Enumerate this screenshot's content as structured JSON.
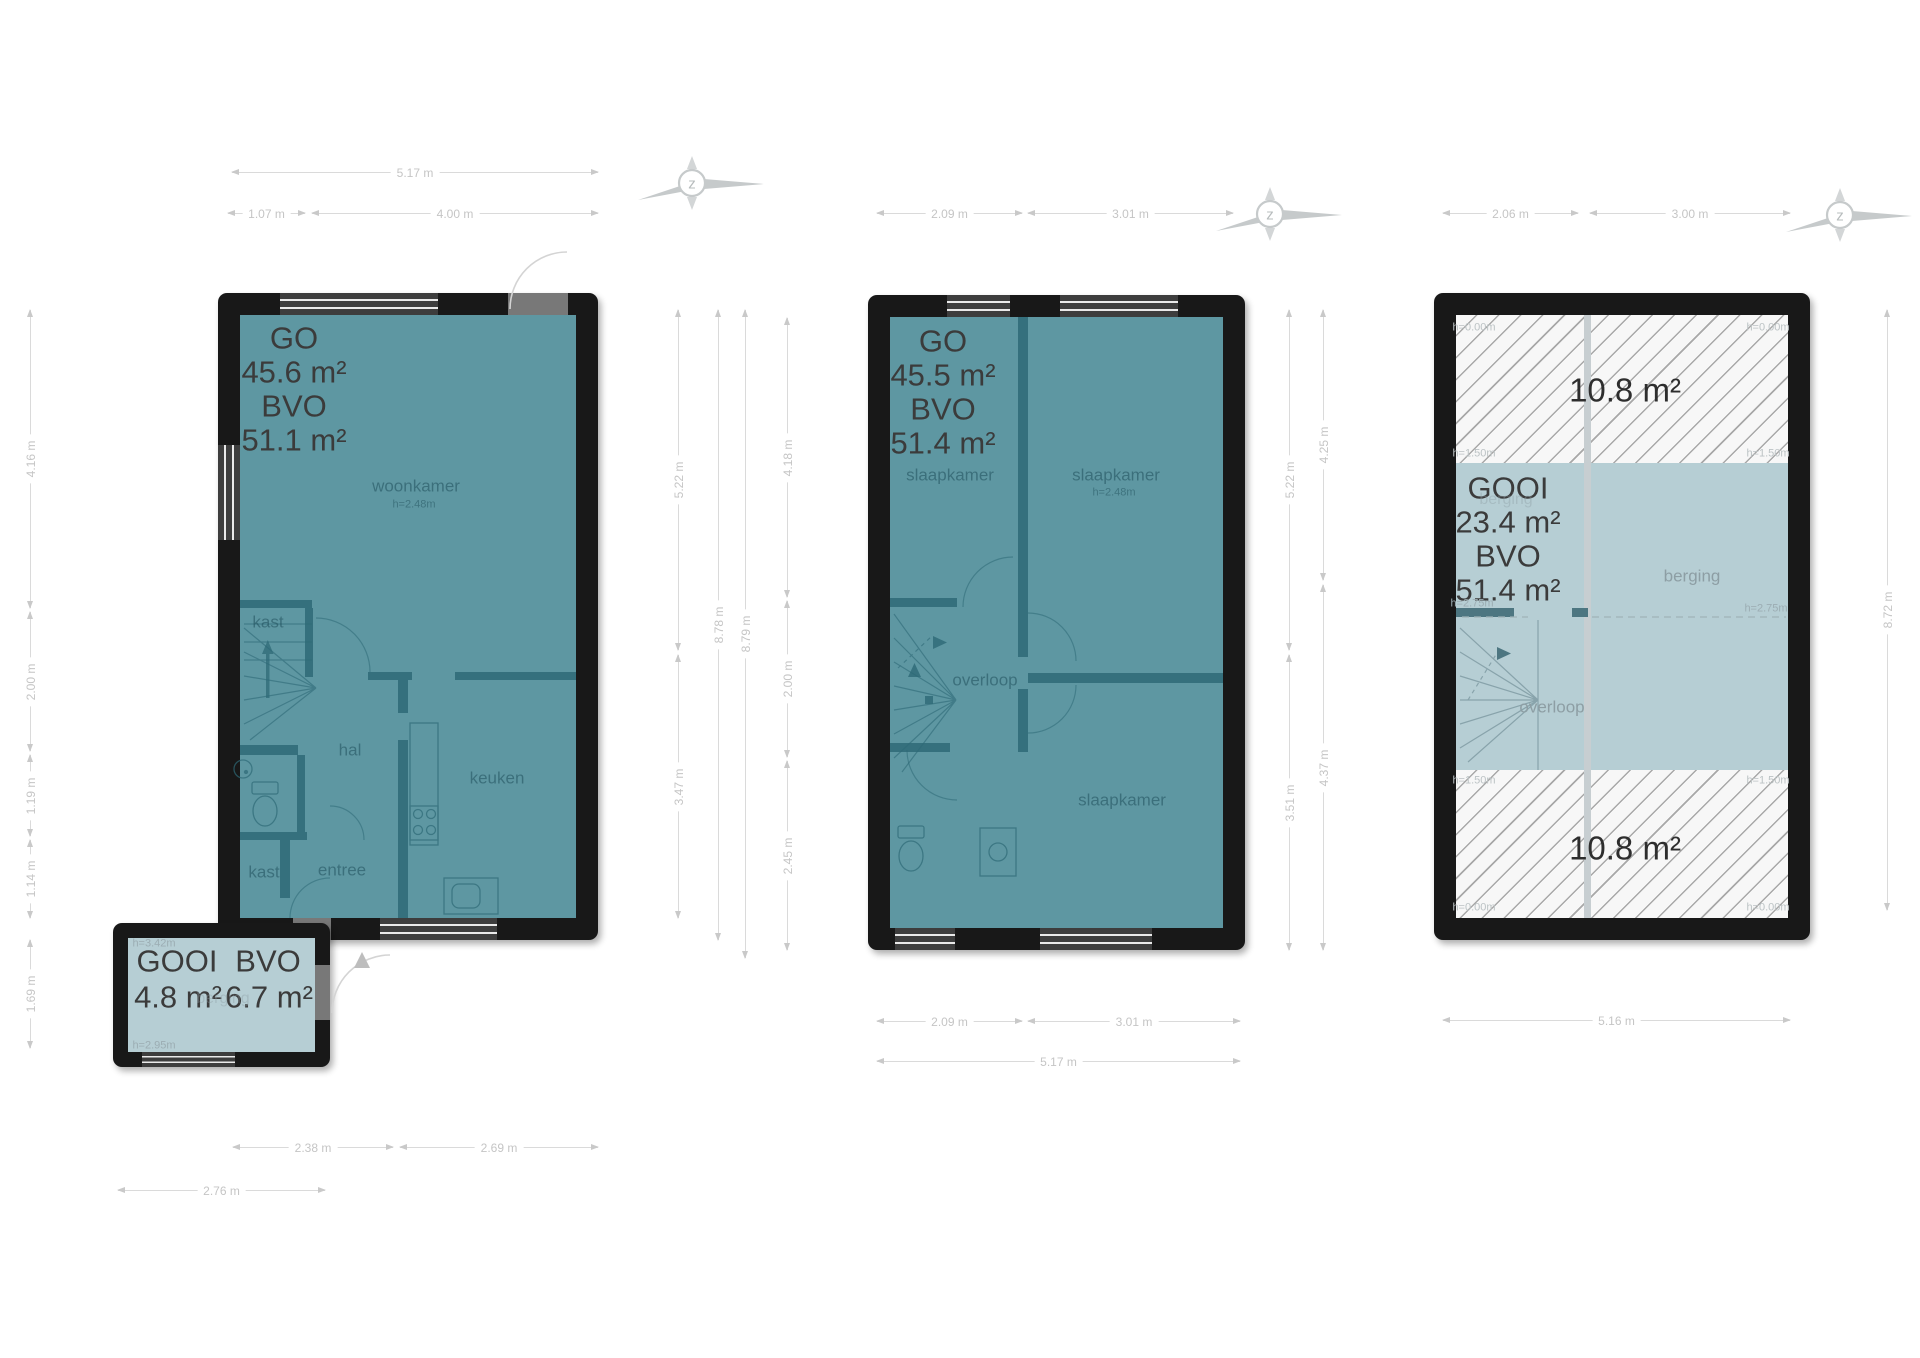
{
  "palette": {
    "floor_teal": "#5e97a2",
    "interior_wall": "#35707d",
    "outer_wall": "#181818",
    "light_blue": "#b6ced4",
    "hatch_bg": "#f7f7f7",
    "hatch_line": "#a8a8a8",
    "area_text": "#3b3b3b",
    "room_text": "#1d4c58",
    "dim_text": "#c5c5c5"
  },
  "compass": {
    "letter": "z",
    "positions": [
      {
        "x": 700,
        "y": 183
      },
      {
        "x": 1278,
        "y": 214
      },
      {
        "x": 1848,
        "y": 215
      }
    ]
  },
  "plans": [
    {
      "name": "ground-floor",
      "labels": [
        {
          "t": "GO",
          "x": 294,
          "y": 338,
          "c": "area"
        },
        {
          "t": "45.6 m²",
          "x": 294,
          "y": 372,
          "c": "area"
        },
        {
          "t": "BVO",
          "x": 294,
          "y": 406,
          "c": "area"
        },
        {
          "t": "51.1 m²",
          "x": 294,
          "y": 440,
          "c": "area"
        },
        {
          "t": "woonkamer",
          "x": 416,
          "y": 486,
          "c": "room"
        },
        {
          "t": "h=2.48m",
          "x": 414,
          "y": 505,
          "c": "hsm"
        },
        {
          "t": "kast",
          "x": 268,
          "y": 622,
          "c": "room"
        },
        {
          "t": "hal",
          "x": 350,
          "y": 750,
          "c": "room"
        },
        {
          "t": "keuken",
          "x": 497,
          "y": 778,
          "c": "room"
        },
        {
          "t": "kast",
          "x": 264,
          "y": 872,
          "c": "room"
        },
        {
          "t": "entree",
          "x": 342,
          "y": 870,
          "c": "room"
        }
      ]
    },
    {
      "name": "ground-floor-annex",
      "labels": [
        {
          "t": "GOOI",
          "x": 177,
          "y": 961,
          "c": "area"
        },
        {
          "t": "BVO",
          "x": 268,
          "y": 961,
          "c": "area"
        },
        {
          "t": "4.8 m²",
          "x": 178,
          "y": 997,
          "c": "area"
        },
        {
          "t": "6.7 m²",
          "x": 269,
          "y": 997,
          "c": "area"
        },
        {
          "t": "h=3.42m",
          "x": 154,
          "y": 944,
          "c": "h-blue"
        },
        {
          "t": "berging",
          "x": 223,
          "y": 999,
          "c": "faint"
        },
        {
          "t": "h=2.95m",
          "x": 154,
          "y": 1046,
          "c": "h-blue"
        }
      ]
    },
    {
      "name": "first-floor",
      "labels": [
        {
          "t": "GO",
          "x": 943,
          "y": 341,
          "c": "area"
        },
        {
          "t": "45.5 m²",
          "x": 943,
          "y": 375,
          "c": "area"
        },
        {
          "t": "BVO",
          "x": 943,
          "y": 409,
          "c": "area"
        },
        {
          "t": "51.4 m²",
          "x": 943,
          "y": 443,
          "c": "area"
        },
        {
          "t": "slaapkamer",
          "x": 950,
          "y": 475,
          "c": "room"
        },
        {
          "t": "slaapkamer",
          "x": 1116,
          "y": 475,
          "c": "room"
        },
        {
          "t": "h=2.48m",
          "x": 1114,
          "y": 493,
          "c": "hsm"
        },
        {
          "t": "overloop",
          "x": 985,
          "y": 680,
          "c": "room"
        },
        {
          "t": "slaapkamer",
          "x": 1122,
          "y": 800,
          "c": "room"
        }
      ]
    },
    {
      "name": "attic-floor",
      "labels": [
        {
          "t": "10.8 m²",
          "x": 1625,
          "y": 390,
          "c": "big"
        },
        {
          "t": "h=0.00m",
          "x": 1474,
          "y": 328,
          "c": "h-lt"
        },
        {
          "t": "h=0.00m",
          "x": 1768,
          "y": 328,
          "c": "h-lt"
        },
        {
          "t": "h=1.50m",
          "x": 1474,
          "y": 454,
          "c": "h-lt"
        },
        {
          "t": "h=1.50m",
          "x": 1768,
          "y": 454,
          "c": "h-lt"
        },
        {
          "t": "GOOI",
          "x": 1508,
          "y": 488,
          "c": "area"
        },
        {
          "t": "berging",
          "x": 1506,
          "y": 500,
          "c": "faint"
        },
        {
          "t": "23.4 m²",
          "x": 1508,
          "y": 522,
          "c": "area"
        },
        {
          "t": "BVO",
          "x": 1508,
          "y": 556,
          "c": "area"
        },
        {
          "t": "51.4 m²",
          "x": 1508,
          "y": 590,
          "c": "area"
        },
        {
          "t": "berging",
          "x": 1692,
          "y": 576,
          "c": "room-lt"
        },
        {
          "t": "h=2.75m",
          "x": 1472,
          "y": 604,
          "c": "h-blue"
        },
        {
          "t": "h=2.75m",
          "x": 1766,
          "y": 609,
          "c": "h-blue"
        },
        {
          "t": "overloop",
          "x": 1552,
          "y": 707,
          "c": "room-lt"
        },
        {
          "t": "h=1.50m",
          "x": 1474,
          "y": 781,
          "c": "h-lt"
        },
        {
          "t": "h=1.50m",
          "x": 1768,
          "y": 781,
          "c": "h-lt"
        },
        {
          "t": "h=0.00m",
          "x": 1474,
          "y": 908,
          "c": "h-lt"
        },
        {
          "t": "h=0.00m",
          "x": 1768,
          "y": 908,
          "c": "h-lt"
        },
        {
          "t": "10.8 m²",
          "x": 1625,
          "y": 848,
          "c": "big"
        }
      ]
    }
  ],
  "dimensions": [
    {
      "o": "h",
      "x": 232,
      "y": 172,
      "len": 366,
      "t": "5.17 m"
    },
    {
      "o": "h",
      "x": 228,
      "y": 213,
      "len": 77,
      "t": "1.07 m"
    },
    {
      "o": "h",
      "x": 312,
      "y": 213,
      "len": 286,
      "t": "4.00 m"
    },
    {
      "o": "h",
      "x": 877,
      "y": 213,
      "len": 145,
      "t": "2.09 m"
    },
    {
      "o": "h",
      "x": 1028,
      "y": 213,
      "len": 205,
      "t": "3.01 m"
    },
    {
      "o": "h",
      "x": 1443,
      "y": 213,
      "len": 135,
      "t": "2.06 m"
    },
    {
      "o": "h",
      "x": 1590,
      "y": 213,
      "len": 200,
      "t": "3.00 m"
    },
    {
      "o": "h",
      "x": 233,
      "y": 1147,
      "len": 160,
      "t": "2.38 m"
    },
    {
      "o": "h",
      "x": 400,
      "y": 1147,
      "len": 198,
      "t": "2.69 m"
    },
    {
      "o": "h",
      "x": 118,
      "y": 1190,
      "len": 207,
      "t": "2.76 m"
    },
    {
      "o": "h",
      "x": 877,
      "y": 1021,
      "len": 145,
      "t": "2.09 m"
    },
    {
      "o": "h",
      "x": 1028,
      "y": 1021,
      "len": 212,
      "t": "3.01 m"
    },
    {
      "o": "h",
      "x": 877,
      "y": 1061,
      "len": 363,
      "t": "5.17 m"
    },
    {
      "o": "h",
      "x": 1443,
      "y": 1020,
      "len": 347,
      "t": "5.16 m"
    },
    {
      "o": "v",
      "x": 30,
      "y": 310,
      "len": 298,
      "t": "4.16 m"
    },
    {
      "o": "v",
      "x": 30,
      "y": 612,
      "len": 139,
      "t": "2.00 m"
    },
    {
      "o": "v",
      "x": 30,
      "y": 755,
      "len": 81,
      "t": "1.19 m"
    },
    {
      "o": "v",
      "x": 30,
      "y": 840,
      "len": 78,
      "t": "1.14 m"
    },
    {
      "o": "v",
      "x": 30,
      "y": 940,
      "len": 108,
      "t": "1.69 m"
    },
    {
      "o": "v",
      "x": 678,
      "y": 310,
      "len": 340,
      "t": "5.22 m"
    },
    {
      "o": "v",
      "x": 678,
      "y": 655,
      "len": 263,
      "t": "3.47 m"
    },
    {
      "o": "v",
      "x": 718,
      "y": 310,
      "len": 630,
      "t": "8.78 m"
    },
    {
      "o": "v",
      "x": 745,
      "y": 310,
      "len": 648,
      "t": "8.79 m"
    },
    {
      "o": "v",
      "x": 787,
      "y": 318,
      "len": 279,
      "t": "4.18 m"
    },
    {
      "o": "v",
      "x": 787,
      "y": 601,
      "len": 156,
      "t": "2.00 m"
    },
    {
      "o": "v",
      "x": 787,
      "y": 761,
      "len": 189,
      "t": "2.45 m"
    },
    {
      "o": "v",
      "x": 1289,
      "y": 310,
      "len": 340,
      "t": "5.22 m"
    },
    {
      "o": "v",
      "x": 1289,
      "y": 655,
      "len": 295,
      "t": "3.51 m"
    },
    {
      "o": "v",
      "x": 1323,
      "y": 310,
      "len": 270,
      "t": "4.25 m"
    },
    {
      "o": "v",
      "x": 1323,
      "y": 585,
      "len": 365,
      "t": "4.37 m"
    },
    {
      "o": "v",
      "x": 1887,
      "y": 310,
      "len": 600,
      "t": "8.72 m"
    }
  ]
}
